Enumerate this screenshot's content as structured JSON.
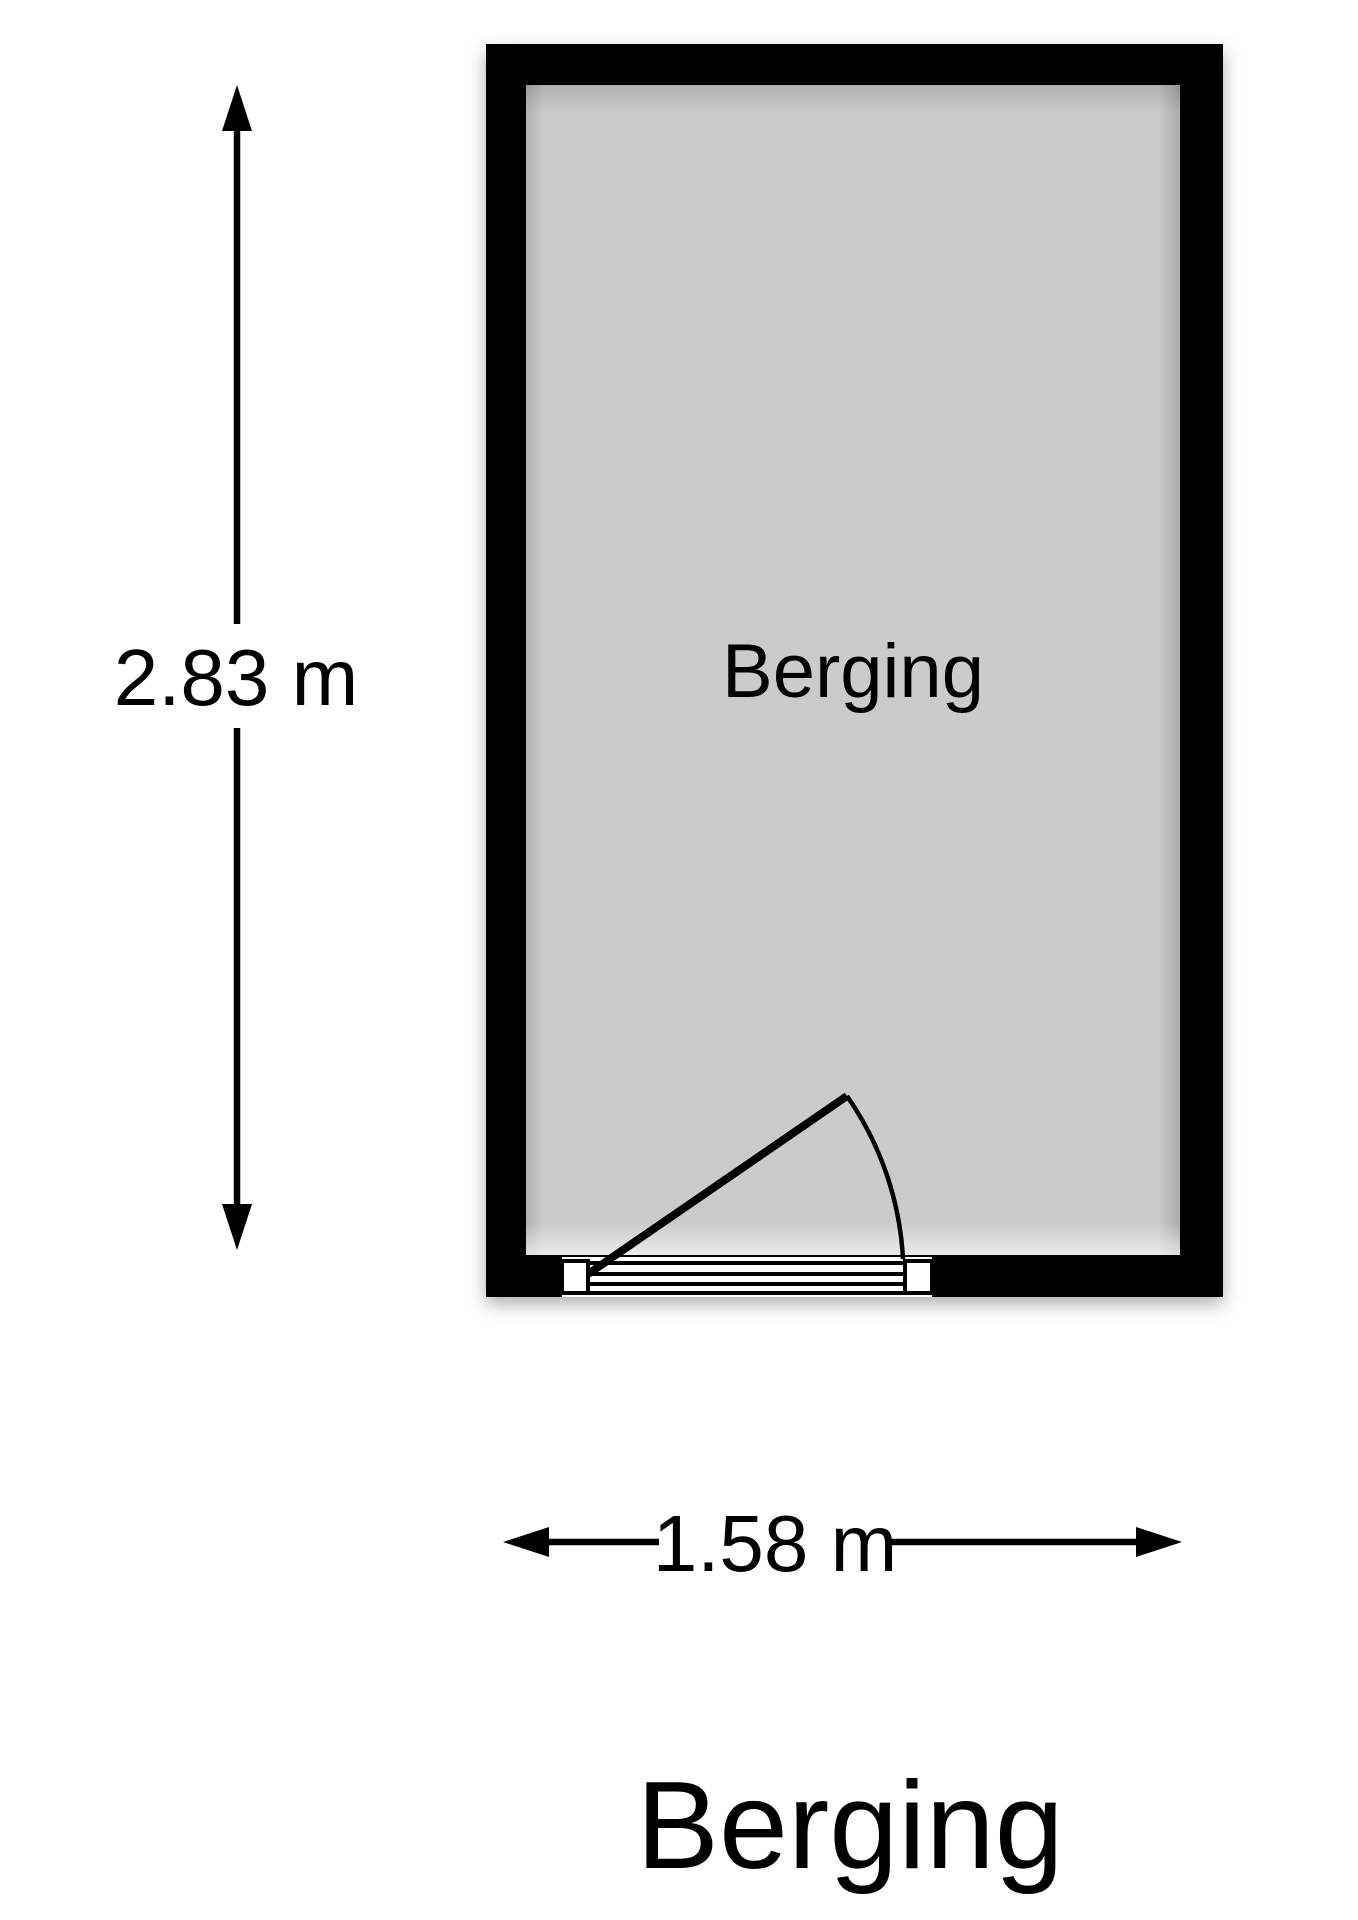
{
  "floorplan": {
    "title": "Berging",
    "room": {
      "name": "Berging",
      "height_dimension": "2.83 m",
      "width_dimension": "1.58 m"
    },
    "colors": {
      "wall": "#000000",
      "floor": "#cbcbcb",
      "background": "#ffffff",
      "line": "#000000"
    }
  }
}
